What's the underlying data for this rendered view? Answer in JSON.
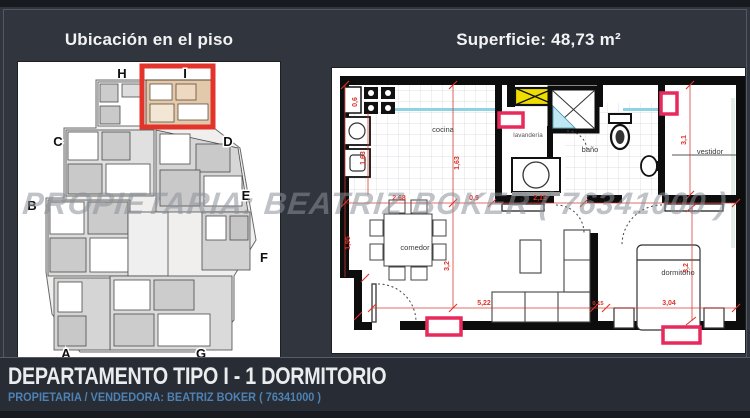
{
  "left_panel": {
    "title": "Ubicación en el piso",
    "units": [
      "A",
      "B",
      "C",
      "D",
      "E",
      "F",
      "G",
      "H",
      "I"
    ],
    "highlighted_unit": "I"
  },
  "right_panel": {
    "title": "Superficie: 48,73 m²",
    "rooms": {
      "cocina": "cocina",
      "lavanderia": "lavandería",
      "bano": "baño",
      "vestidor": "vestidor",
      "comedor": "comedor",
      "dormitorio": "dormitorio",
      "tv_a": "tv",
      "tv_b": "tv"
    },
    "dimensions": {
      "w06": "0,6",
      "h163a": "1,63",
      "h163b": "1,63",
      "w268": "2,68",
      "w09": "0,9",
      "w215": "2,15",
      "h195": "1,95",
      "h32a": "3,2",
      "w522": "5,22",
      "w015": "0,15",
      "w304": "3,04",
      "h32b": "3,2",
      "h31": "3,1"
    }
  },
  "watermark": {
    "text": "PROPIETARIA: BEATRIZ BOKER ( 76341000 )"
  },
  "footer": {
    "title": "DEPARTAMENTO TIPO I - 1 DORMITORIO",
    "subtitle": "PROPIETARIA / VENDEDORA: BEATRIZ BOKER ( 76341000 )"
  },
  "colors": {
    "background": "#31353e",
    "footer_bar": "#282c34",
    "highlight_red": "#e2342b",
    "marker_pink": "#e8295c",
    "dimension_red": "#d8342a",
    "footer_blue": "#4e82b4",
    "counter_blue": "#8fd2e2",
    "laundry_yellow": "#f0dd00",
    "unit_fill_tan": "#e3c9ab"
  }
}
